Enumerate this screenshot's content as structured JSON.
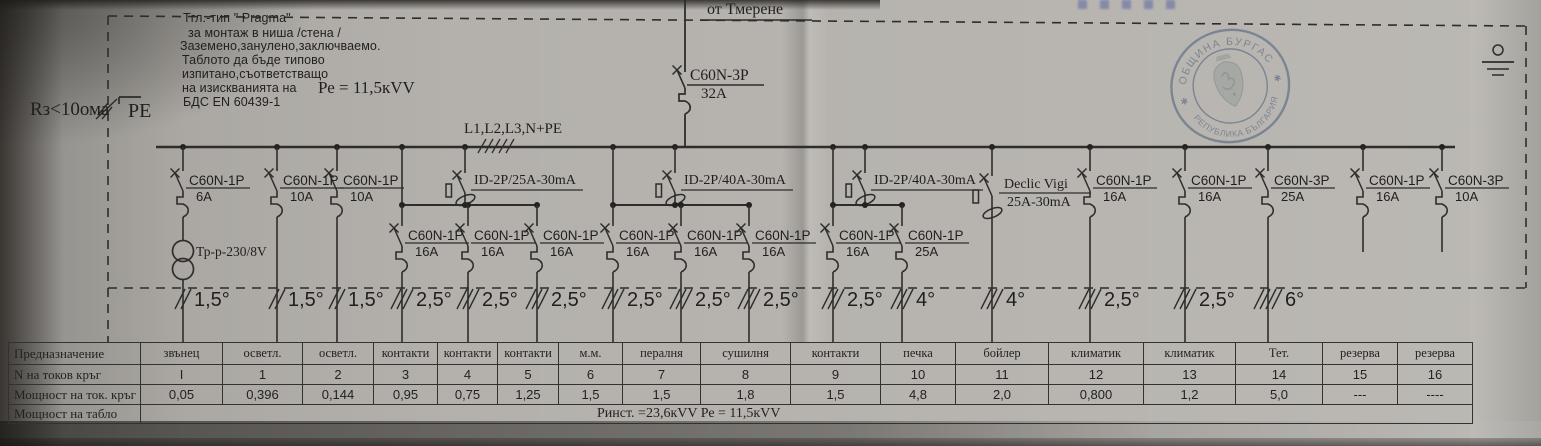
{
  "incoming_label": "от Тмерене",
  "main_breaker": {
    "model": "C60N-3P",
    "rating": "32A"
  },
  "bus_label": "L1,L2,L3,N+PE",
  "pe": {
    "label": "PE",
    "earth_resistance": "Rз<10ома"
  },
  "notes": {
    "lines": [
      "Тгл.-тип \" Pragma\"",
      "за монтаж в ниша /стена /",
      "Заземено,занулено,заключваемо.",
      "Таблото да бъде типово",
      "изпитано,съответстващо",
      "на изискванията на",
      "БДС EN 60439-1"
    ],
    "pe_power": "Ре = 11,5кVV"
  },
  "circuits": [
    {
      "kind": "breaker",
      "x": 183,
      "model": "C60N-1P",
      "rating": "6A",
      "wire": "1,5°",
      "accessory": {
        "type": "transformer",
        "label": "Тр-р-230/8V"
      }
    },
    {
      "kind": "breaker",
      "x": 277,
      "model": "C60N-1P",
      "rating": "10A",
      "wire": "1,5°"
    },
    {
      "kind": "breaker",
      "x": 337,
      "model": "C60N-1P",
      "rating": "10A",
      "wire": "1,5°"
    },
    {
      "kind": "rcd-group",
      "rcd_x": 465,
      "riser_x": 402,
      "model": "ID-2P/25A-30mA",
      "children": [
        {
          "x": 402,
          "model": "C60N-1P",
          "rating": "16A",
          "wire": "2,5°"
        },
        {
          "x": 468,
          "model": "C60N-1P",
          "rating": "16A",
          "wire": "2,5°"
        },
        {
          "x": 537,
          "model": "C60N-1P",
          "rating": "16A",
          "wire": "2,5°"
        }
      ]
    },
    {
      "kind": "rcd-group",
      "rcd_x": 675,
      "riser_x": 613,
      "model": "ID-2P/40A-30mA",
      "children": [
        {
          "x": 613,
          "model": "C60N-1P",
          "rating": "16A",
          "wire": "2,5°"
        },
        {
          "x": 681,
          "model": "C60N-1P",
          "rating": "16A",
          "wire": "2,5°"
        },
        {
          "x": 749,
          "model": "C60N-1P",
          "rating": "16A",
          "wire": "2,5°"
        }
      ]
    },
    {
      "kind": "rcd-group",
      "rcd_x": 865,
      "riser_x": 833,
      "model": "ID-2P/40A-30mA",
      "children": [
        {
          "x": 833,
          "model": "C60N-1P",
          "rating": "16A",
          "wire": "2,5°"
        },
        {
          "x": 902,
          "model": "C60N-1P",
          "rating": "25A",
          "wire": "4°"
        }
      ]
    },
    {
      "kind": "vigi",
      "x": 992,
      "model": "Declic Vigi",
      "rating": "25A-30mA",
      "wire": "4°"
    },
    {
      "kind": "breaker",
      "x": 1090,
      "model": "C60N-1P",
      "rating": "16A",
      "wire": "2,5°"
    },
    {
      "kind": "breaker",
      "x": 1185,
      "model": "C60N-1P",
      "rating": "16A",
      "wire": "2,5°"
    },
    {
      "kind": "breaker",
      "x": 1268,
      "model": "C60N-3P",
      "rating": "25A",
      "wire": "6°"
    },
    {
      "kind": "breaker",
      "x": 1363,
      "model": "C60N-1P",
      "rating": "16A",
      "wire": null
    },
    {
      "kind": "breaker",
      "x": 1442,
      "model": "C60N-3P",
      "rating": "10A",
      "wire": null
    }
  ],
  "stamp": {
    "top_text": "ОБЩИНА БУРГАС",
    "bottom_text": "РЕПУБЛИКА БЪЛГАРИЯ",
    "color": "#4f74a4"
  },
  "table": {
    "row_labels": [
      "Предназначение",
      "N  на токов кръг",
      "Мощност на ток. кръг",
      "Мощност на табло"
    ],
    "columns": [
      {
        "purpose": "звънец",
        "num": "I",
        "power": "0,05"
      },
      {
        "purpose": "осветл.",
        "num": "1",
        "power": "0,396"
      },
      {
        "purpose": "осветл.",
        "num": "2",
        "power": "0,144"
      },
      {
        "purpose": "контакти",
        "num": "3",
        "power": "0,95"
      },
      {
        "purpose": "контакти",
        "num": "4",
        "power": "0,75"
      },
      {
        "purpose": "контакти",
        "num": "5",
        "power": "1,25"
      },
      {
        "purpose": "м.м.",
        "num": "6",
        "power": "1,5"
      },
      {
        "purpose": "пералня",
        "num": "7",
        "power": "1,5"
      },
      {
        "purpose": "сушилня",
        "num": "8",
        "power": "1,8"
      },
      {
        "purpose": "контакти",
        "num": "9",
        "power": "1,5"
      },
      {
        "purpose": "печка",
        "num": "10",
        "power": "4,8"
      },
      {
        "purpose": "бойлер",
        "num": "11",
        "power": "2,0"
      },
      {
        "purpose": "климатик",
        "num": "12",
        "power": "0,800"
      },
      {
        "purpose": "климатик",
        "num": "13",
        "power": "1,2"
      },
      {
        "purpose": "Тет.",
        "num": "14",
        "power": "5,0"
      },
      {
        "purpose": "резерва",
        "num": "15",
        "power": "---"
      },
      {
        "purpose": "резерва",
        "num": "16",
        "power": "----"
      }
    ],
    "summary": "Ринст. =23,6кVV    Ре = 11,5кVV"
  }
}
